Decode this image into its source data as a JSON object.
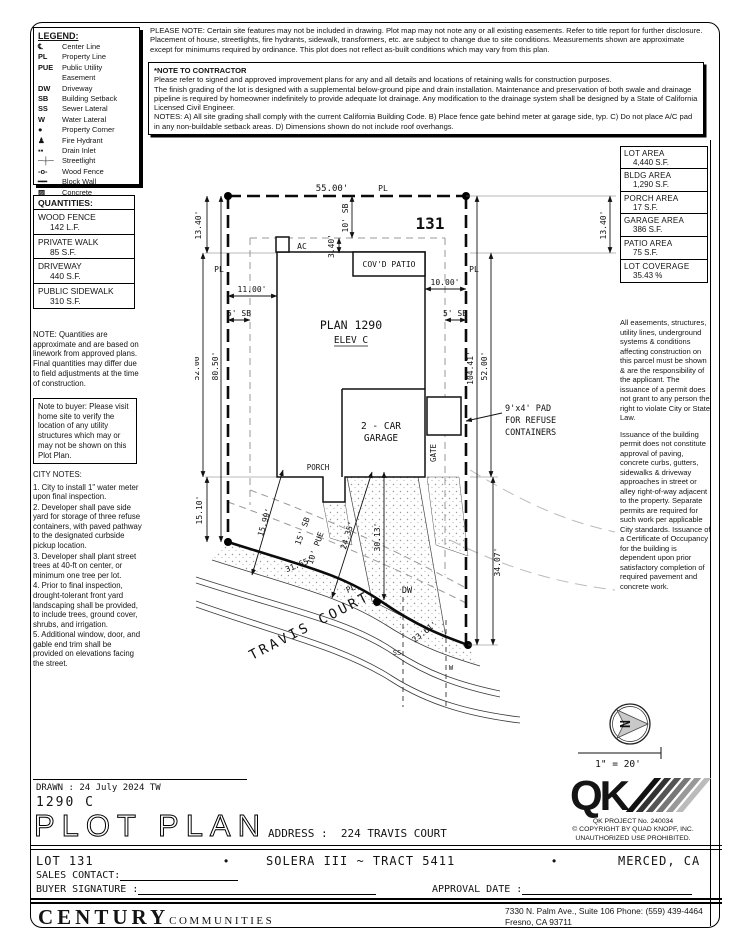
{
  "notes": {
    "please_note": "PLEASE NOTE:  Certain site features may not be included in drawing.  Plot map may not note any or all existing easements. Refer to title report for further disclosure.  Placement of house, streetlights, fire hydrants, sidewalk, transformers, etc. are subject to change due to site conditions.  Measurements shown are approximate except for minimums required by ordinance.  This plot does not reflect as-built conditions which may vary from this plan.",
    "contractor_title": "*NOTE TO CONTRACTOR",
    "contractor_paragraphs": [
      "Please refer to signed and approved improvement plans for any and all details and locations of retaining walls for construction purposes.",
      "The finish grading of the lot is designed with a supplemental below-ground pipe and drain installation.  Maintenance and preservation of both swale and drainage pipeline is required by homeowner indefinitely to provide adequate lot drainage.  Any modification to the drainage system shall be designed by a State of California Licensed Civil Engineer.",
      "NOTES:  A) All site grading shall comply with the current California Building Code.  B) Place fence gate behind meter at garage side, typ.  C) Do not place A/C pad in any non-buildable setback areas.  D) Dimensions shown do not include roof overhangs."
    ]
  },
  "legend": {
    "title": "LEGEND:",
    "items": [
      {
        "symbol": "℄",
        "label": "Center Line"
      },
      {
        "symbol": "PL",
        "label": "Property Line"
      },
      {
        "symbol": "PUE",
        "label": "Public Utility Easement"
      },
      {
        "symbol": "DW",
        "label": "Driveway"
      },
      {
        "symbol": "SB",
        "label": "Building Setback"
      },
      {
        "symbol": "SS",
        "label": "Sewer Lateral"
      },
      {
        "symbol": "W",
        "label": "Water Lateral"
      },
      {
        "symbol": "●",
        "label": "Property Corner"
      },
      {
        "symbol": "♟",
        "label": "Fire Hydrant"
      },
      {
        "symbol": "▪▪",
        "label": "Drain Inlet"
      },
      {
        "symbol": "─┼─",
        "label": "Streetlight"
      },
      {
        "symbol": "-o-",
        "label": "Wood Fence"
      },
      {
        "symbol": "━━",
        "label": "Block Wall"
      },
      {
        "symbol": "▨",
        "label": "Concrete"
      }
    ]
  },
  "areas": {
    "items": [
      {
        "label": "LOT AREA",
        "value": "4,440 S.F."
      },
      {
        "label": "BLDG AREA",
        "value": "1,290 S.F."
      },
      {
        "label": "PORCH AREA",
        "value": "17 S.F."
      },
      {
        "label": "GARAGE AREA",
        "value": "386 S.F."
      },
      {
        "label": "PATIO AREA",
        "value": "75 S.F."
      },
      {
        "label": "LOT COVERAGE",
        "value": "35.43 %"
      }
    ]
  },
  "right_notes": {
    "p1": "All easements, structures, utility lines, underground systems & conditions affecting construction on this parcel must be shown & are the responsibility of the applicant. The issuance of a permit does not grant to any person the right to violate City or State Law.",
    "p2": "Issuance of the building permit does not constitute approval of paving, concrete curbs, gutters, sidewalks & driveway approaches in street or alley right-of-way adjacent to the property. Separate permits are required for such work per applicable City standards. Issuance of a Certificate of Occupancy for the building is dependent upon prior satisfactory completion of required pavement and concrete work."
  },
  "quantities": {
    "title": "QUANTITIES:",
    "items": [
      {
        "label": "WOOD FENCE",
        "value": "142 L.F."
      },
      {
        "label": "PRIVATE WALK",
        "value": "85 S.F."
      },
      {
        "label": "DRIVEWAY",
        "value": "440 S.F."
      },
      {
        "label": "PUBLIC SIDEWALK",
        "value": "310 S.F."
      }
    ],
    "note": "NOTE: Quantities are approximate and are based on linework from approved plans.  Final quantities may differ due to field adjustments at the time of construction."
  },
  "buyer_note": "Note to buyer: Please visit home site to verify the location of any utility structures which may or may not be shown on this Plot Plan.",
  "city_notes": {
    "title": "CITY NOTES:",
    "items": [
      "1. City to install 1\" water meter upon final inspection.",
      "2. Developer shall pave side yard for storage of three refuse containers, with paved pathway to the designated curbside pickup location.",
      "3. Developer shall plant street trees at 40-ft on center, or minimum one tree per lot.",
      "4. Prior to final inspection, drought-tolerant front yard landscaping shall be provided, to include trees, ground cover, shrubs, and irrigation.",
      "5. Additional window, door, and gable end trim shall be provided on elevations facing the street."
    ]
  },
  "plot": {
    "lot_number": "131",
    "plan": "PLAN 1290",
    "elev": "ELEV C",
    "garage_line1": "2 - CAR",
    "garage_line2": "GARAGE",
    "porch": "PORCH",
    "gate": "GATE",
    "ac": "AC",
    "covd_patio": "COV'D PATIO",
    "pad_line1": "9'x4' PAD",
    "pad_line2": "FOR REFUSE",
    "pad_line3": "CONTAINERS",
    "street": "TRAVIS COURT",
    "north": "N",
    "scale": "1\" = 20'",
    "labels": {
      "pl": "PL",
      "dw": "DW",
      "ss": "SS",
      "w": "W"
    },
    "dims": {
      "top_width": "55.00'",
      "left_upper": "13.40'",
      "left_mid": "52.00'",
      "left_lower": "15.10'",
      "left_total": "80.50'",
      "right_upper": "13.40'",
      "right_total": "104.41'",
      "right_mid": "52.00'",
      "right_lower": "34.07'",
      "rear_sb": "10' SB",
      "ac_off": "3.40'",
      "side_left": "11.00'",
      "side_right": "10.00'",
      "sb5": "5' SB",
      "front1": "15.99'",
      "front2": "24.35'",
      "front3": "30.13'",
      "curve1": "31.65'",
      "curve2": "23.61'",
      "front_sb": "15' SB",
      "pue": "10' PUE"
    }
  },
  "qk": {
    "mark": "QK",
    "project": "QK PROJECT No. 240034",
    "copyright": "©  COPYRIGHT BY QUAD KNOPF, INC.",
    "notice": "UNAUTHORIZED USE PROHIBITED."
  },
  "titleblock": {
    "drawn": "DRAWN :  24 July 2024  TW",
    "plan_code": "1290  C",
    "title": "PLOT PLAN",
    "address_label": "ADDRESS :",
    "address": "224 TRAVIS COURT",
    "lot": "LOT 131",
    "tract": "SOLERA III ~ TRACT 5411",
    "city": "MERCED, CA",
    "bullet": "•",
    "sales_label": "SALES CONTACT:",
    "signature_label": "BUYER SIGNATURE :",
    "approval_label": "APPROVAL DATE :"
  },
  "footer": {
    "brand": "CENTURY",
    "brand2": "COMMUNITIES",
    "addr1": "7330 N. Palm Ave., Suite 106    Phone:  (559) 439-4464",
    "addr2": "Fresno, CA  93711"
  }
}
